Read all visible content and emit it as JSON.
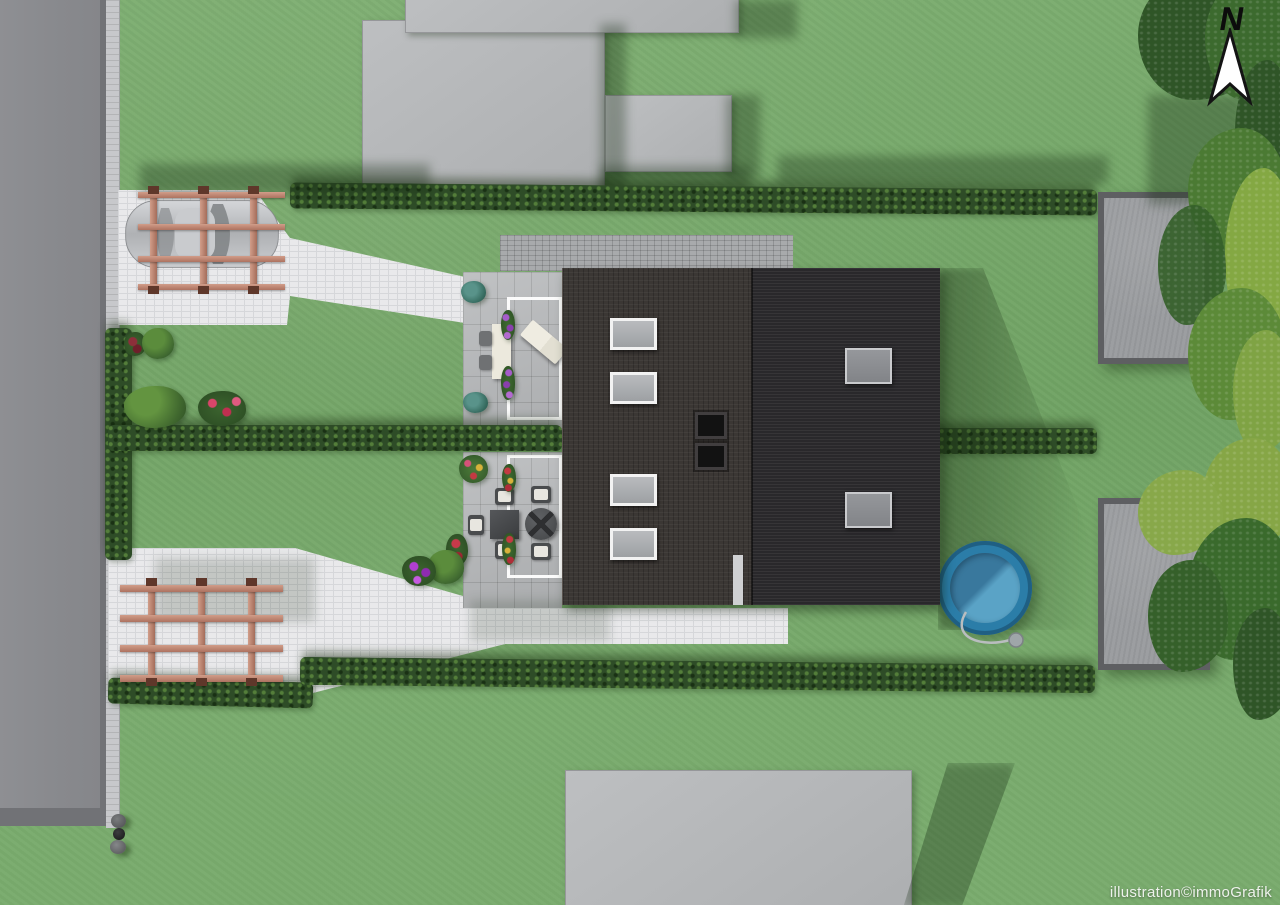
{
  "compass": {
    "label": "N"
  },
  "watermark": {
    "text": "illustration©immoGrafik"
  },
  "colors": {
    "grass": "#74a867",
    "hedge": "#2e4c27",
    "road": "#8a8b8f",
    "road-border": "#717276",
    "sidewalk": "#c7c8cb",
    "paving-white": "#e9e9eb",
    "paving-joint": "#d6d7da",
    "patio": "#b7b9bb",
    "walkway": "#a8aaac",
    "roof-left": "#3b3734",
    "roof-right": "#29282b",
    "skylight-frame": "#f2f2f2",
    "chimney": "#141414",
    "pergola-wood": "#c08a76",
    "pergola-cap": "#5f372a",
    "car-body": "#b9bbbe",
    "pool-rim": "#2b7da8",
    "pool-water": "#4e95ba",
    "shed": "#9c9ea1",
    "shed-border": "#5e5f62",
    "building": "#b6b8ba",
    "table-white": "#ece9dd",
    "furniture-dark": "#4a4c4e",
    "cushion": "#e8e6e0",
    "watermark-color": "#eef2ec",
    "north-fill": "#ffffff",
    "north-stroke": "#141414"
  },
  "scene": {
    "objects": [
      "street",
      "sidewalk",
      "waste-bins",
      "carport-with-car",
      "pergola",
      "semi-detached-house",
      "skylights",
      "roof-windows",
      "chimneys",
      "upper-terrace",
      "lower-terrace",
      "garden-hedges",
      "round-pool",
      "garden-shed-upper",
      "garden-shed-lower",
      "trees",
      "neighbor-buildings",
      "north-arrow",
      "watermark"
    ],
    "skylight_count": 4,
    "roof_window_count": 2,
    "chimney_count": 2
  }
}
